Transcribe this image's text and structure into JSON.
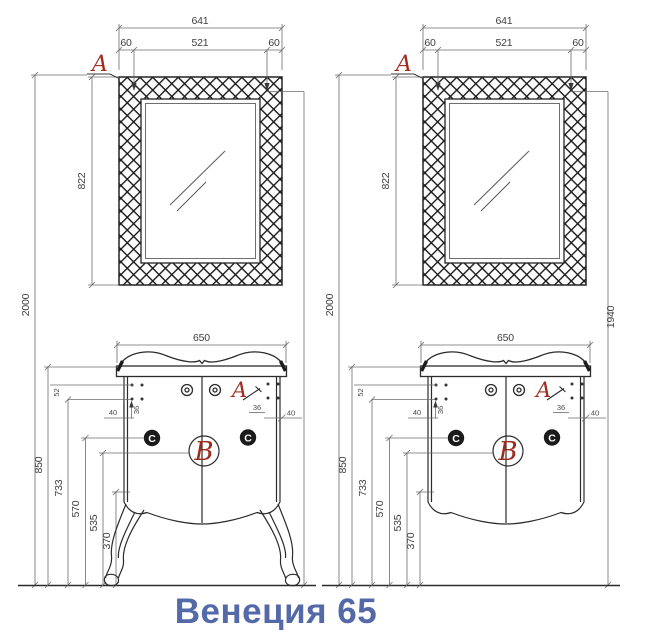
{
  "title": "Венеция 65",
  "colors": {
    "detail_marker_red": "#9d2c1e",
    "title_blue": "#5469a8",
    "drawing_line": "#2b2b2b"
  },
  "mirror": {
    "overall_width": "641",
    "frame_band": "60",
    "glass_width": "521",
    "height": "822",
    "detail_label": "A"
  },
  "installation": {
    "overall_height": "2000",
    "glass_top_height": "1940"
  },
  "cabinet": {
    "width": "650",
    "top_height": "850",
    "hinge_plate_height": "733",
    "hinge_height": "570",
    "detail_b_height": "535",
    "carcass_bottom_height": "370",
    "hinge_row_gap": "52",
    "edge_offset": "40",
    "cup_offset": "36",
    "detail_a_label": "A",
    "detail_b_label": "B",
    "hinge_label": "C"
  }
}
